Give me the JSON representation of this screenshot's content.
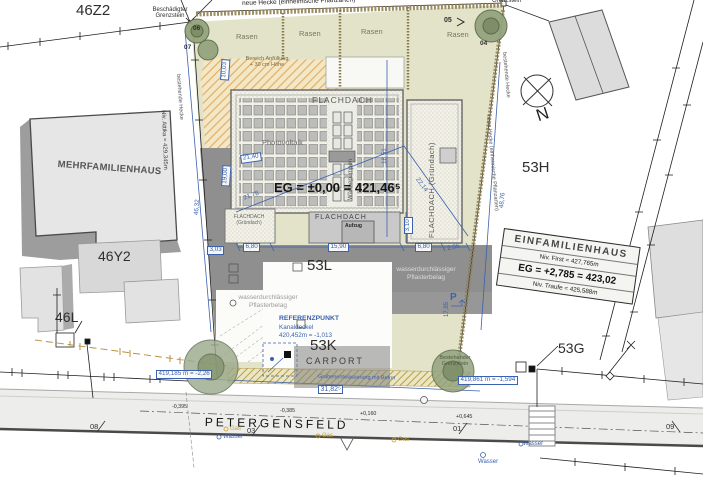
{
  "parcels": {
    "p46z2": "46Z2",
    "p46y2": "46Y2",
    "p46l": "46L",
    "p53h": "53H",
    "p53l": "53L",
    "p53k": "53K",
    "p53g": "53G"
  },
  "buildings": {
    "mfh": "MEHRFAMILIENHAUS",
    "mfh_attika": "Niv. Attika = 429,345m",
    "efh": "EINFAMILIENHAUS",
    "efh_first": "Niv. First = 427,765m",
    "efh_eg": "EG = +2,785 = 423,02",
    "efh_traufe": "Niv. Traufe = 425,588m",
    "flachdach": "FLACHDACH",
    "photovoltaik": "Photovoltaik",
    "eg_level": "EG = ±0,00 = 421,46⁵",
    "gruendach": "FLACHDACH (Gründach)",
    "gruendach_line1": "FLACHDACH",
    "gruendach_line2": "(Gründach)",
    "flachdach_lower": "FLACHDACH",
    "aufzug": "Aufzug",
    "waermepumpen": "Wärmepumpen",
    "flachdach_garage": "FLACHDACH",
    "carport": "CARPORT"
  },
  "site": {
    "rasen": [
      "Rasen",
      "Rasen",
      "Rasen",
      "Rasen"
    ],
    "neue_hecke": "neue Hecke (einheimische Pflanzarten)",
    "bestehende_hecke_left": "bestehende Hecke",
    "bestehende_hecke_right": "bestehende Hecke",
    "neue_hecke_right": "neue Hecke (einheimische Pflanzarten)",
    "anfuellung_1": "Bereich Anfüllung",
    "anfuellung_2": "+ 30 cm Höhe",
    "pflaster_1": "wasserdurchlässiger",
    "pflaster_2": "Pflasterbelag",
    "graben": "Grabenentwässerung mit Beton",
    "grenzstein_damaged_1": "Beschädigter",
    "grenzstein_damaged_2": "Grenzstein",
    "grenzstein_top": "Grenzstein",
    "grenzstein_exist_1": "Bestehender",
    "grenzstein_exist_2": "Grenzstein"
  },
  "reference": {
    "title": "REFERENZPUNKT",
    "line1": "Kanaldeckel",
    "line2": "420,452m = -1,013"
  },
  "dims": {
    "w1003": "10,03",
    "w1900": "19,00",
    "w303": "3,03",
    "w2140": "21,40",
    "diag1": "21,78",
    "diag2": "22,14",
    "h1851": "18,51",
    "h310": "3,10",
    "len_left": "46,32",
    "len_right": "48,76",
    "b1": "6,80",
    "b2": "15,90",
    "b3": "6,80",
    "b4": "2,96",
    "carport_len": "31,82⁵",
    "h1785": "17,85"
  },
  "levels": {
    "tree_left": "419,185 m = -2,26",
    "tree_right": "419,861 m = -1,594",
    "s1": "-0,395",
    "s2": "-0,385",
    "s3": "+0,160",
    "s4": "+0,645"
  },
  "street": {
    "name": "PETERGENSFELD",
    "m08": "08",
    "m03": "03",
    "m01": "01",
    "m09": "09",
    "wasser": "Wasser",
    "gas": "Gas"
  },
  "markers": {
    "t06": "06",
    "t07": "07",
    "t05": "05",
    "t04": "04"
  },
  "compass": {
    "n": "N"
  },
  "parking": {
    "p": "P"
  },
  "colors": {
    "dim_blue": "#3a62ae",
    "plot_beige": "#e3e3ca",
    "shadow_gray": "#8f8f8f"
  }
}
